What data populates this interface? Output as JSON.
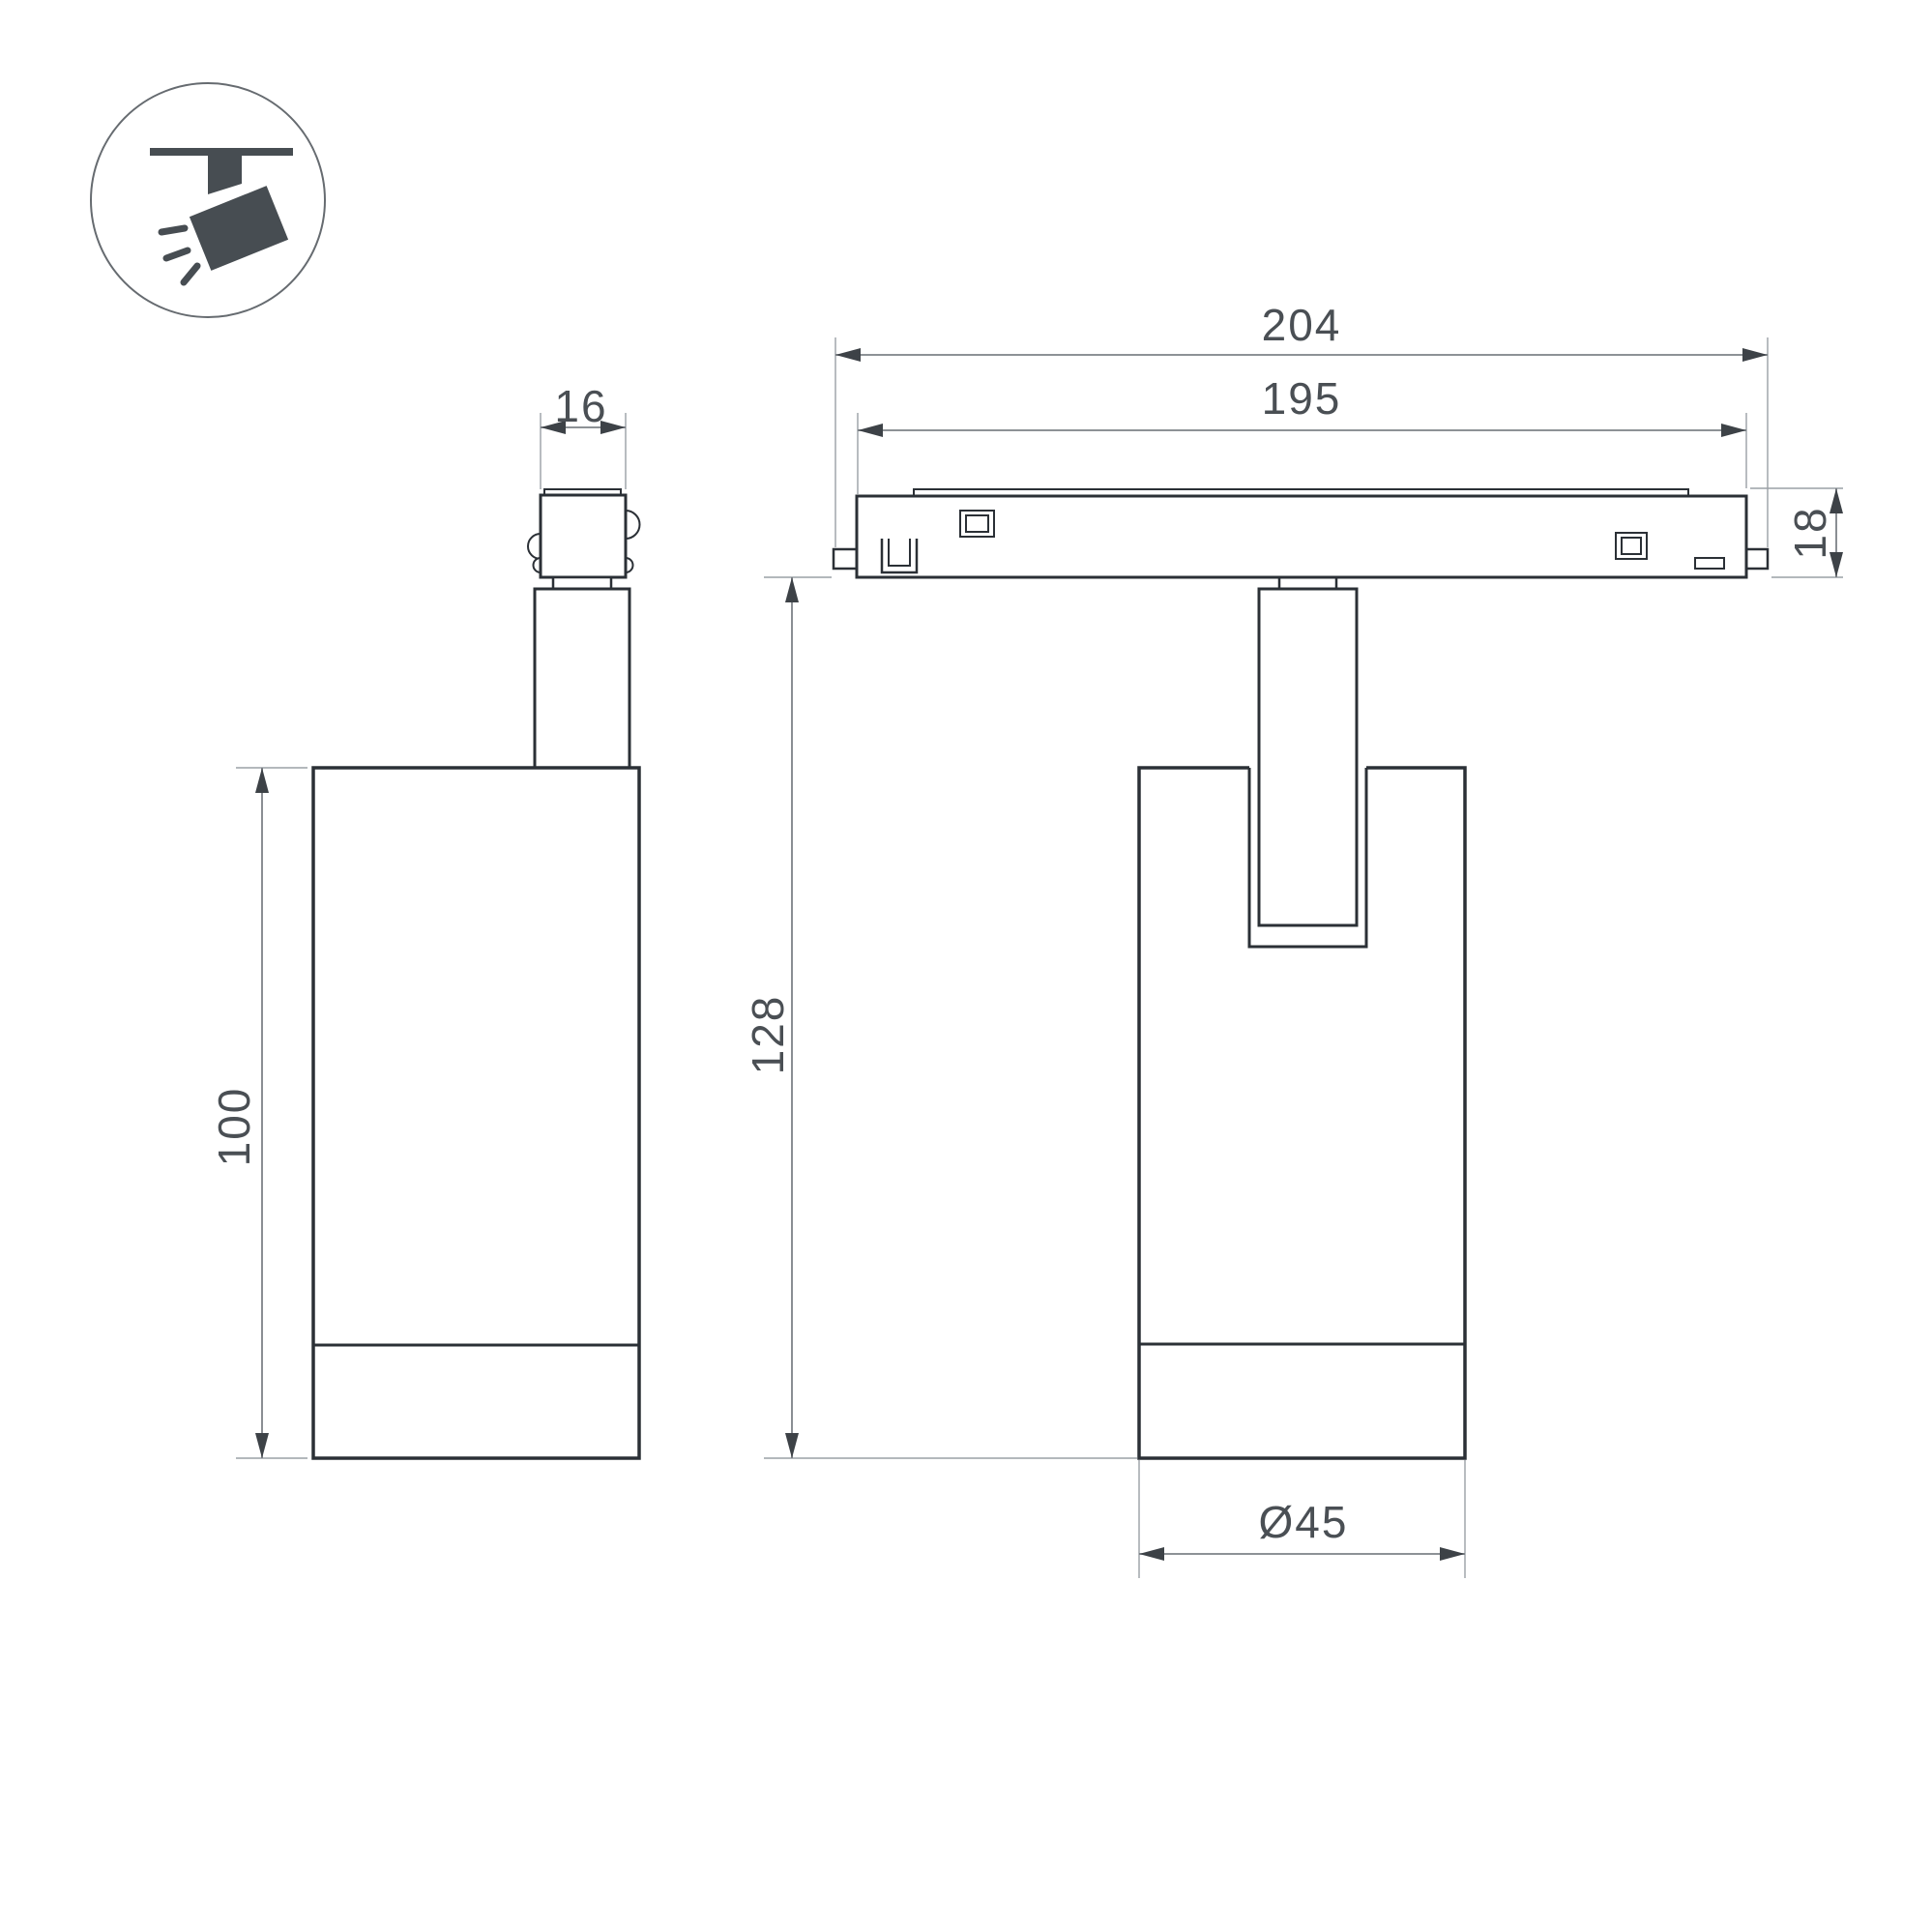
{
  "drawing": {
    "kind": "track-spotlight-dimensional-drawing",
    "background": "#ffffff"
  },
  "colors": {
    "outline": "#2b3036",
    "icon": "#474d52",
    "dimension_line": "#7d8287",
    "extension_line": "#9aa0a5",
    "arrow": "#3d4247",
    "dimension_text": "#4a4f54"
  },
  "icon": {
    "name": "track-spotlight-icon"
  },
  "views": {
    "side": {
      "name": "side-view"
    },
    "front": {
      "name": "front-view-on-track"
    }
  },
  "dimensions": {
    "adapter_width": {
      "value": "16"
    },
    "body_height": {
      "value": "100"
    },
    "track_length_overall": {
      "value": "204"
    },
    "track_length_inner": {
      "value": "195"
    },
    "track_height": {
      "value": "18"
    },
    "suspension_height": {
      "value": "128"
    },
    "body_diameter": {
      "value": "Ø45"
    }
  }
}
